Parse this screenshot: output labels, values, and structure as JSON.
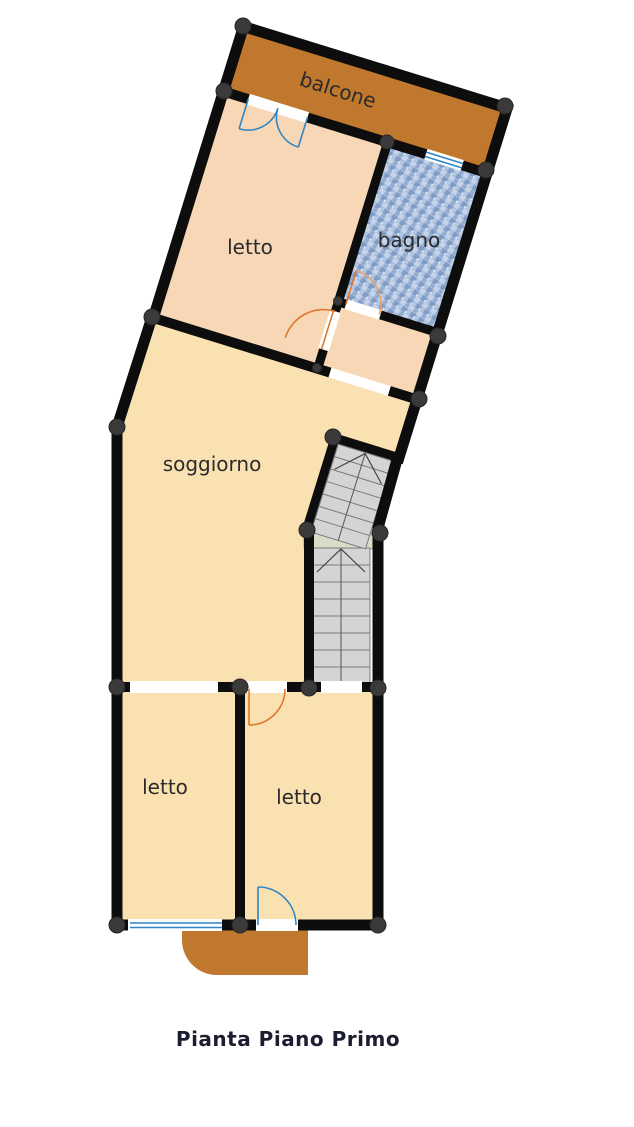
{
  "plan": {
    "caption": "Pianta Piano Primo",
    "rooms": [
      {
        "name": "balcone",
        "label": "balcone"
      },
      {
        "name": "letto-upper",
        "label": "letto"
      },
      {
        "name": "bagno",
        "label": "bagno"
      },
      {
        "name": "soggiorno",
        "label": "soggiorno"
      },
      {
        "name": "letto-lower-left",
        "label": "letto"
      },
      {
        "name": "letto-lower-right",
        "label": "letto"
      }
    ],
    "features": {
      "stairs_upper": "stair flight (tilted)",
      "stairs_lower": "stair flight (straight)",
      "balcony_lower": "rounded balcony at entrance"
    }
  },
  "colors": {
    "wall": "#0d0d0d",
    "node": "#3a3a3a",
    "balcony": "#c0772e",
    "bedroom_floor": "#f8d7b6",
    "living_floor": "#fae1b1",
    "bath_base": "#a4bbda",
    "bath_tile_dark": "#7e9cc6",
    "bath_tile_light": "#c6d3e8",
    "stair": "#d4d4d4",
    "stair_line": "#7a7a7a",
    "landing": "#d9dcc9",
    "interior_door": "#e0782a",
    "exterior_door": "#2e86c6",
    "label": "#2b2b2b",
    "caption": "#1d1d30"
  }
}
